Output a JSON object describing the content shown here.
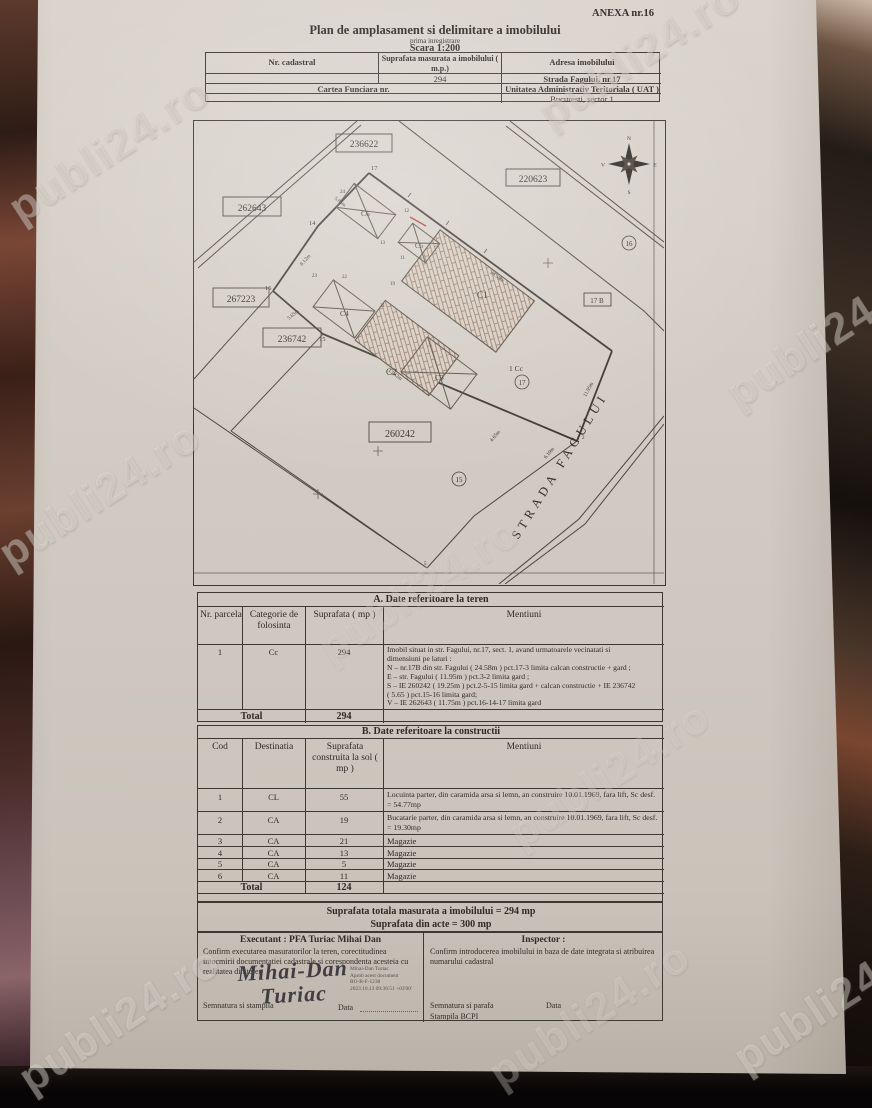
{
  "annex": "ANEXA nr.16",
  "watermark": "publi24.ro",
  "title": {
    "main": "Plan de amplasament si delimitare a imobilului",
    "sub": "prima inregistrare",
    "scale": "Scara 1:200"
  },
  "header_table": {
    "nr_cadastral_label": "Nr. cadastral",
    "suprafata_label": "Suprafata masurata a imobilului ( m.p.)",
    "adresa_label": "Adresa imobilului",
    "suprafata_value": "294",
    "adresa_value": "Strada Fagului, nr.17",
    "carte_funciara_label": "Cartea Funciara nr.",
    "uat_label": "Unitatea Administrativ Teritoriala ( UAT )",
    "uat_value": "Bucuresti, sector 1"
  },
  "map": {
    "parcels": [
      "236622",
      "220623",
      "262643",
      "267223",
      "236742",
      "260242"
    ],
    "neighbor": "17 B",
    "cc": "1 Cc",
    "circled": [
      "16",
      "17",
      "15"
    ],
    "street": "STRADA FAGULUI",
    "compass": {
      "n": "N",
      "e": "E",
      "s": "S",
      "v": "V"
    },
    "buildings": [
      "C1",
      "C2",
      "C3",
      "C4",
      "C5",
      "C6"
    ],
    "red_points": [
      "17",
      "14",
      "16",
      "15"
    ],
    "point_nums": [
      "24",
      "13",
      "12",
      "23",
      "22",
      "21",
      "11",
      "19",
      "5",
      "2"
    ],
    "dims": [
      "5.85m",
      "24.58m",
      "8.12m",
      "5.65m",
      "13.62m",
      "11.95m",
      "4.65m",
      "6.10m"
    ]
  },
  "table_a": {
    "title": "A. Date referitoare la teren",
    "col_nr": "Nr. parcela",
    "col_cat": "Categorie de folosinta",
    "col_sup": "Suprafata ( mp )",
    "col_men": "Mentiuni",
    "row": {
      "nr": "1",
      "cat": "Cc",
      "sup": "294",
      "mentiuni": [
        "Imobil situat in str. Fagului, nr.17, sect. 1, avand urmatoarele vecinatati si",
        "dimensiuni pe laturi :",
        "N – nr.17B din str. Fagului ( 24.58m ) pct.17-3 limita calcan constructie + gard ;",
        "E –  str. Fagului ( 11.95m ) pct.3-2 limita gard ;",
        "S –  IE 260242 ( 19.25m ) pct.2-5-15 limita gard + calcan constructie + IE 236742",
        "( 5.65 ) pct.15-16 limita gard;",
        "V – IE 262643 ( 11.75m ) pct.16-14-17 limita gard"
      ]
    },
    "total_label": "Total",
    "total_value": "294"
  },
  "table_b": {
    "title": "B. Date referitoare la constructii",
    "col_cod": "Cod",
    "col_dest": "Destinatia",
    "col_sup": "Suprafata construita la sol ( mp )",
    "col_men": "Mentiuni",
    "rows": [
      {
        "cod": "1",
        "dest": "CL",
        "sup": "55",
        "men": "Locuinta parter, din caramida arsa si lemn, an construire 10.01.1969, fara lift, Sc desf. = 54.77mp"
      },
      {
        "cod": "2",
        "dest": "CA",
        "sup": "19",
        "men": "Bucatarie parter, din caramida arsa si lemn, an construire 10.01.1969, fara lift, Sc desf. = 19.30mp"
      },
      {
        "cod": "3",
        "dest": "CA",
        "sup": "21",
        "men": "Magazie"
      },
      {
        "cod": "4",
        "dest": "CA",
        "sup": "13",
        "men": "Magazie"
      },
      {
        "cod": "5",
        "dest": "CA",
        "sup": "5",
        "men": "Magazie"
      },
      {
        "cod": "6",
        "dest": "CA",
        "sup": "11",
        "men": "Magazie"
      }
    ],
    "total_label": "Total",
    "total_value": "124"
  },
  "summary": {
    "line1": "Suprafata totala masurata a imobilului = 294 mp",
    "line2": "Suprafata din acte = 300 mp"
  },
  "footer": {
    "executant_title": "Executant : PFA Turiac Mihai Dan",
    "executant_text": "Confirm executarea masuratorilor la teren, corectitudinea intocmirii documentatiei cadastrale si corespondenta acesteia cu realitatea din teren",
    "signature_line1": "Mihai-Dan",
    "signature_line2": "Turiac",
    "digital_sig": [
      "Mihai-Dan Turiac",
      "Aprob acest document",
      "RO-B-F-1238",
      "2023.10.13 09:36:51 +03'00'"
    ],
    "semnatura_stampila": "Semnatura si stampila",
    "data_label": "Data",
    "inspector_title": "Inspector :",
    "inspector_text": "Confirm introducerea imobilului in baza de date integrata si atribuirea numarului cadastral",
    "semnatura_parafa": "Semnatura si parafa",
    "inspector_data_label": "Data",
    "stampila": "Stampila BCPI"
  }
}
